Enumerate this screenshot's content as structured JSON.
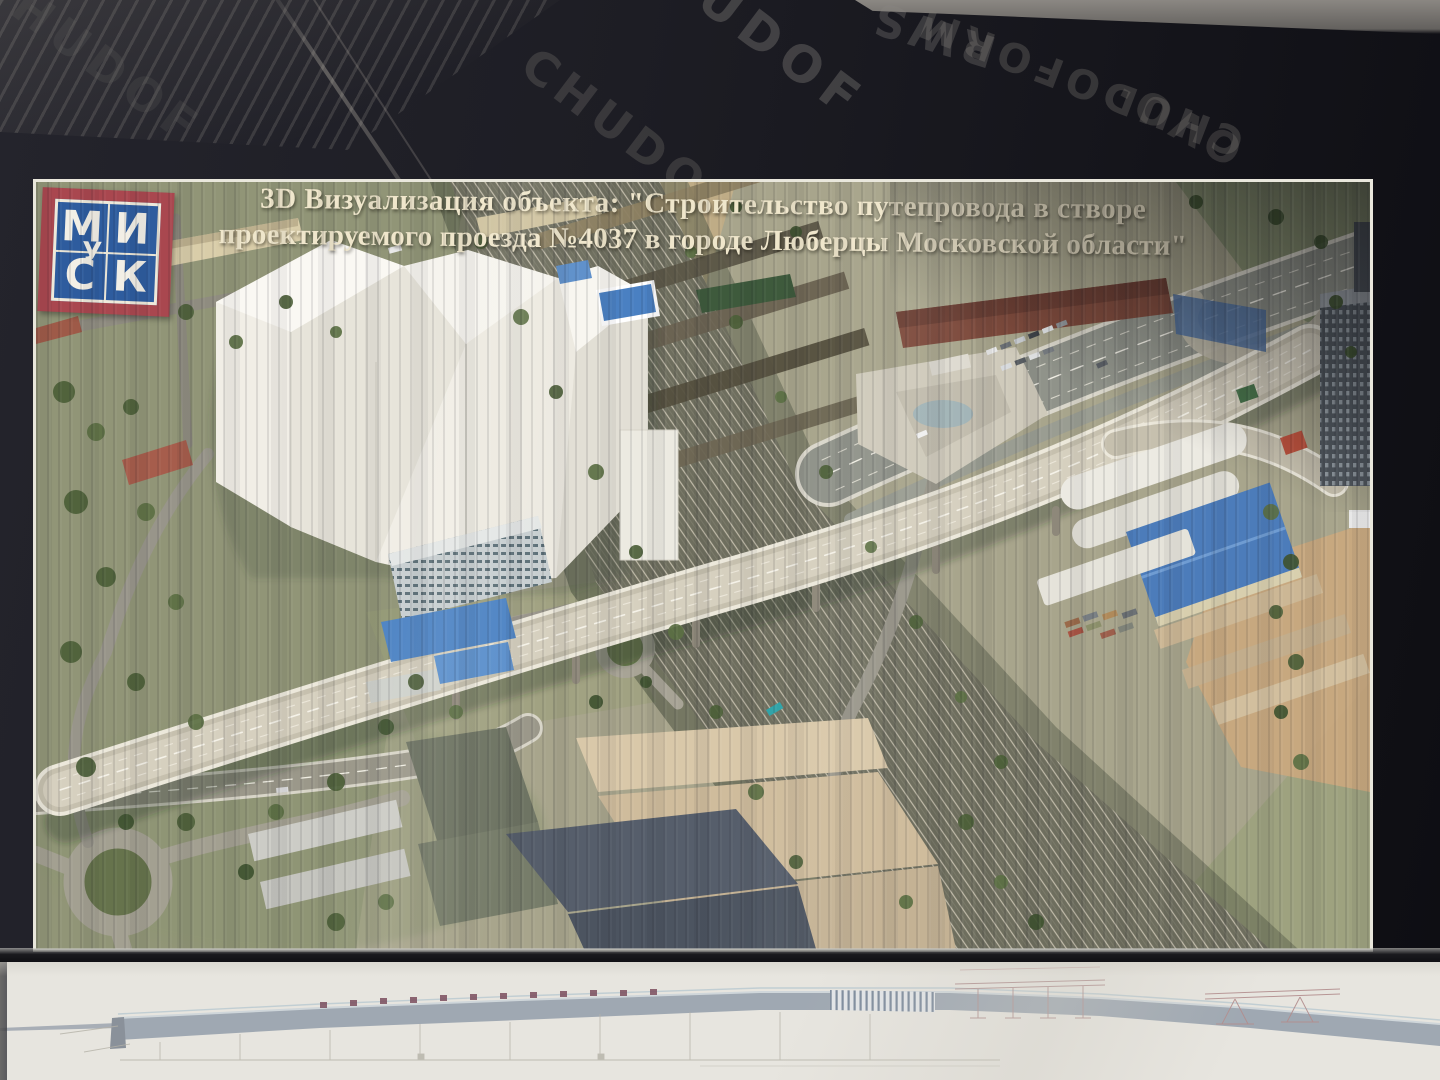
{
  "billboard": {
    "title_line1": "3D Визуализация объекта: \"Строительство путепровода в створе",
    "title_line2": "проектируемого проезда №4037 в городе Люберцы Московской области\"",
    "logo": {
      "top_left": "М",
      "top_right": "И",
      "bottom_left": "С",
      "bottom_right": "К",
      "overlay": "У",
      "frame_color": "#a9474f",
      "field_color": "#2e5c9e",
      "letter_color": "#f2efe6"
    }
  },
  "plywood": {
    "watermarks": [
      "CHUDOF",
      "CHUDO",
      "CHUDOFORM",
      "RWS",
      "OVO·"
    ]
  },
  "colors": {
    "plywood_dark": "#1d1d24",
    "title_text": "#efe6cb",
    "banner_frame": "#e9e7dc",
    "render_ground": "#a8a58c",
    "bridge_deck": "#c6c0ae",
    "blue_roof": "#4c7cba",
    "paper": "#e7e5df",
    "profile_band": "#9fa8b2",
    "pier_marker": "#7b4e5e"
  }
}
